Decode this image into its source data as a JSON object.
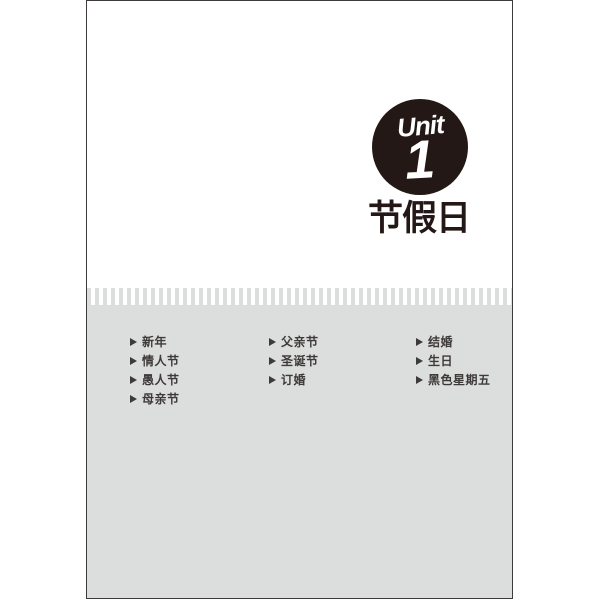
{
  "unit": {
    "label": "Unit",
    "number": "1",
    "title": "节假日"
  },
  "topics": {
    "columns": [
      {
        "items": [
          "新年",
          "情人节",
          "愚人节",
          "母亲节"
        ]
      },
      {
        "items": [
          "父亲节",
          "圣诞节",
          "订婚"
        ]
      },
      {
        "items": [
          "结婚",
          "生日",
          "黑色星期五"
        ]
      }
    ]
  },
  "colors": {
    "badge_black": "#231815",
    "panel_gray": "#dcdddd",
    "text_dark": "#3e3a39",
    "page_border": "#3e3a39"
  }
}
